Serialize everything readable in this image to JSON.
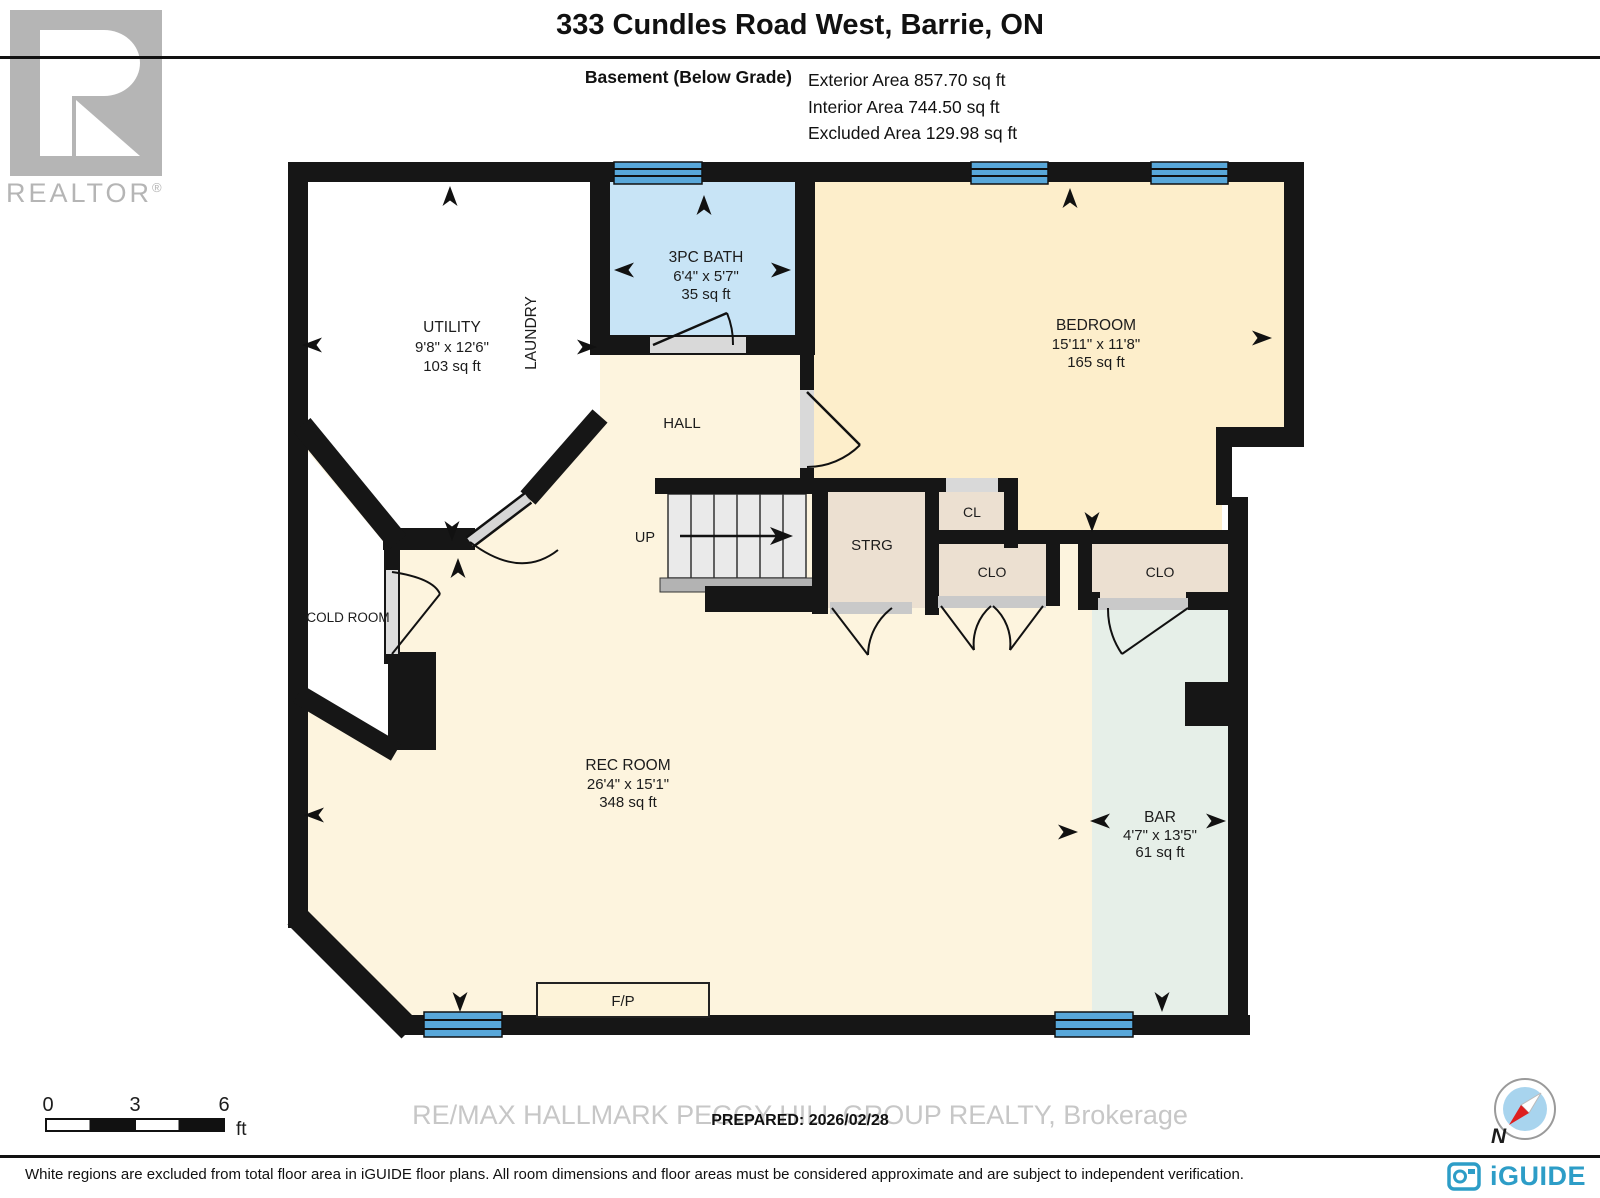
{
  "header": {
    "title": "333 Cundles Road West, Barrie, ON",
    "floor_label": "Basement (Below Grade)",
    "stats": [
      "Exterior Area 857.70 sq ft",
      "Interior Area 744.50 sq ft",
      "Excluded Area 129.98 sq ft"
    ]
  },
  "realtor_logo": {
    "text": "REALTOR",
    "registered": "®"
  },
  "rooms": {
    "utility": {
      "name": "UTILITY",
      "dims": "9'8\" x 12'6\"",
      "area": "103 sq ft"
    },
    "laundry": {
      "name": "LAUNDRY"
    },
    "bath": {
      "name": "3PC BATH",
      "dims": "6'4\" x 5'7\"",
      "area": "35 sq ft"
    },
    "bedroom": {
      "name": "BEDROOM",
      "dims": "15'11\" x 11'8\"",
      "area": "165 sq ft"
    },
    "hall": {
      "name": "HALL"
    },
    "stairs": {
      "label": "UP"
    },
    "storage": {
      "name": "STRG"
    },
    "closet_small": {
      "name": "CL"
    },
    "closet_1": {
      "name": "CLO"
    },
    "closet_2": {
      "name": "CLO"
    },
    "cold_room": {
      "name": "COLD ROOM"
    },
    "rec_room": {
      "name": "REC ROOM",
      "dims": "26'4\" x 15'1\"",
      "area": "348 sq ft"
    },
    "bar": {
      "name": "BAR",
      "dims": "4'7\" x 13'5\"",
      "area": "61 sq ft"
    },
    "fireplace": {
      "label": "F/P"
    }
  },
  "scale_bar": {
    "ticks": [
      "0",
      "3",
      "6"
    ],
    "unit": "ft"
  },
  "footer": {
    "prepared": "PREPARED: 2026/02/28",
    "watermark": "RE/MAX HALLMARK PEGGY HILL GROUP REALTY, Brokerage",
    "disclaimer": "White regions are excluded from total floor area in iGUIDE floor plans. All room dimensions and floor areas must be considered approximate and are subject to independent verification.",
    "brand": "iGUIDE",
    "compass_north": "N"
  },
  "colors": {
    "walls": "#161616",
    "rec_hall_fill": "#fdf4de",
    "bedroom_fill": "#fdeecb",
    "bath_fill": "#c8e4f6",
    "closet_fill": "#ece0d1",
    "bar_fill": "#e6efe8",
    "excluded_fill": "#ffffff",
    "window_blue": "#58a7d9",
    "brand_blue": "#2d9dc7",
    "compass_red": "#dd1f1f"
  }
}
